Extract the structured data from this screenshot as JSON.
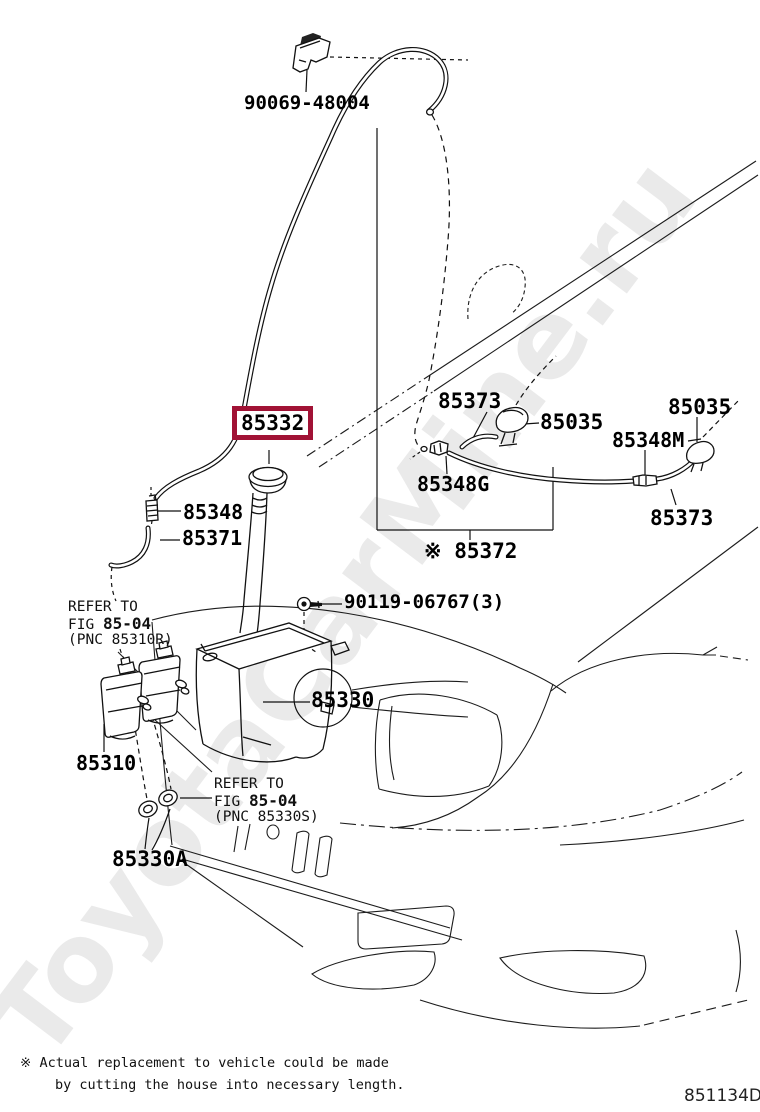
{
  "page": {
    "watermark": "ToyotaCarMine.ru",
    "doc_code": "851134D",
    "footnote_line1": "※ Actual replacement to vehicle could be made",
    "footnote_line2": "by cutting the house into necessary length."
  },
  "parts": {
    "hose_clip": {
      "number": "90069-48004"
    },
    "inlet_cap": {
      "number": "85332",
      "highlighted": true,
      "highlight_color": "#a11235"
    },
    "nozzle_hose_left": {
      "number": "85373"
    },
    "nozzle_left": {
      "number": "85035"
    },
    "nozzle_right": {
      "number": "85035"
    },
    "hose_joint_mid": {
      "number": "85348M"
    },
    "hose_joint_left": {
      "number": "85348G"
    },
    "nozzle_hose_right": {
      "number": "85373"
    },
    "washer_hose": {
      "number": "※ 85372"
    },
    "tank_joint": {
      "number": "85348"
    },
    "tank_tube": {
      "number": "85371"
    },
    "bolt": {
      "number": "90119-06767(3)"
    },
    "washer_jar": {
      "number": "85330"
    },
    "washer_pump": {
      "number": "85310"
    },
    "jar_grommet": {
      "number": "85330A"
    }
  },
  "notes": {
    "refer_pump": {
      "prefix": "REFER TO",
      "fig_label": "FIG",
      "fig_number": "85-04",
      "pnc": "(PNC 85310R)"
    },
    "refer_grommet": {
      "prefix": "REFER TO",
      "fig_label": "FIG",
      "fig_number": "85-04",
      "pnc": "(PNC 85330S)"
    }
  }
}
